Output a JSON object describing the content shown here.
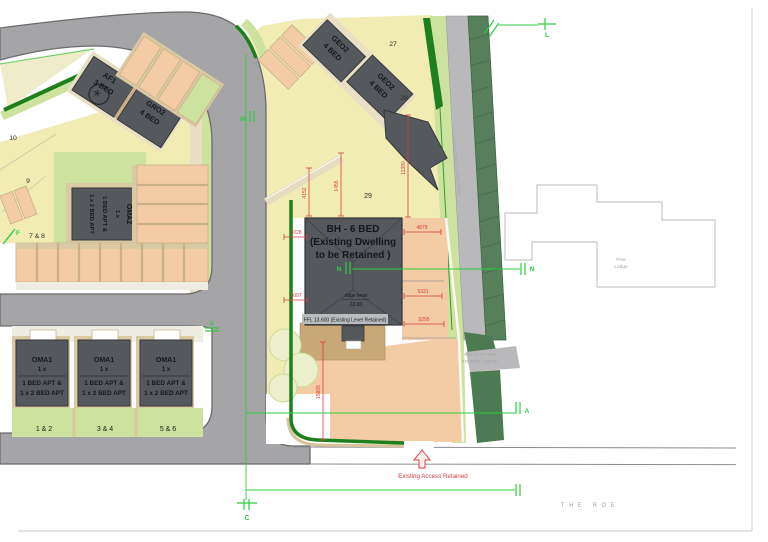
{
  "palette": {
    "road": "#a5a5a7",
    "road_edge": "#6b6b6d",
    "parcel_yellow": "#f0ecb4",
    "drive_peach": "#f3cba4",
    "path_tan": "#d8c8a0",
    "garage_tan": "#c9a878",
    "garden_green": "#cde29e",
    "hedge_green": "#1d801d",
    "row_strip_green": "#567f5c",
    "building_gray": "#55595d",
    "dim_red": "#d84040",
    "survey_green": "#2ecc40"
  },
  "plots": {
    "p27": "27",
    "p28": "28",
    "p29": "29",
    "p10": "10",
    "p9": "9",
    "p7_8": "7 & 8"
  },
  "units": {
    "af1": {
      "l1": "AF1",
      "l2": "3 BED",
      "marker": "*"
    },
    "gro2": {
      "l1": "GRO2",
      "l2": "4 BED"
    },
    "geo2a": {
      "l1": "GEO2",
      "l2": "4 BED"
    },
    "geo2b": {
      "l1": "GEO2",
      "l2": "4 BED"
    },
    "oma2": {
      "l1": "OMA2",
      "l2": "1 x",
      "l3": "1 BED APT &",
      "l4": "1 x 2 BED APT"
    },
    "oma1a": {
      "l1": "OMA1",
      "l2": "1 x",
      "l3": "1 BED APT &",
      "l4": "1 x 2 BED APT",
      "plot": "1 & 2"
    },
    "oma1b": {
      "l1": "OMA1",
      "l2": "1 x",
      "l3": "1 BED APT &",
      "l4": "1 x 2 BED APT",
      "plot": "3 & 4"
    },
    "oma1c": {
      "l1": "OMA1",
      "l2": "1 x",
      "l3": "1 BED APT &",
      "l4": "1 x 2 BED APT",
      "plot": "5 & 6"
    },
    "bh": {
      "l1": "BH - 6 BED",
      "l2": "(Existing Dwelling",
      "l3": "to be Retained )",
      "ridge1": "ridge level",
      "ridge2": "22.00",
      "ffl": "FFL 13.600 (Existing Level Retained)"
    }
  },
  "dims": {
    "d4152": "4152",
    "d1455": "1455",
    "d11380": "11380",
    "d3028": "3028",
    "d3097": "3097",
    "d4879": "4879",
    "d5331": "5331",
    "d5295": "5295",
    "d15805": "15805"
  },
  "markers": {
    "L": "L",
    "M": "M",
    "N1": "N",
    "N2": "N",
    "F": "F",
    "E": "E",
    "C": "C",
    "A": "A"
  },
  "notes": {
    "access": "Existing Access Retained",
    "row1": "RIGHT OF WAY",
    "row2": "TO PINE LODGE",
    "row_strip": "RIGHT OF WAY TO PINE LODGE",
    "street": "THE ROE",
    "pine1": "Pine",
    "pine2": "Lodge"
  }
}
